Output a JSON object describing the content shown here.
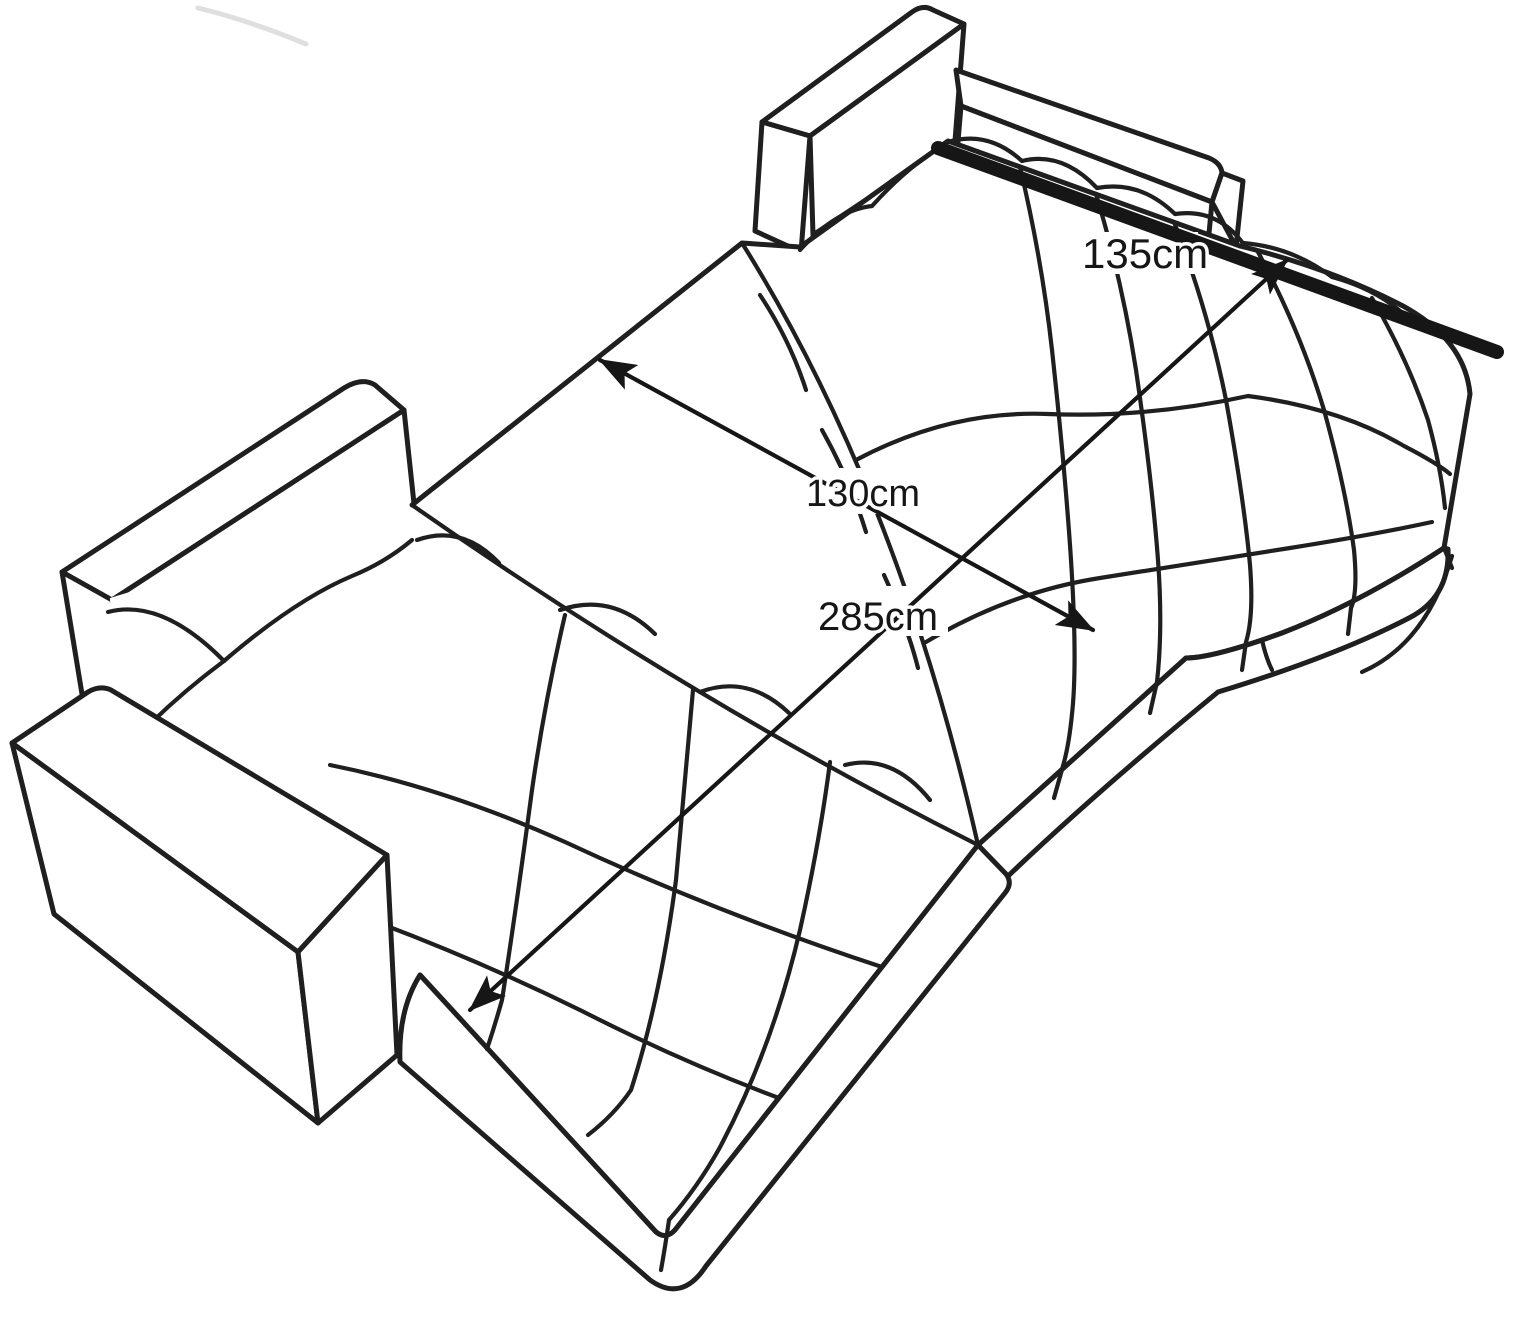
{
  "diagram": {
    "type": "furniture-dimension-line-drawing",
    "subject": "corner sofa bed unfolded into a double bed, isometric outline sketch",
    "colors": {
      "line": "#1f1f1f",
      "dim": "#161616",
      "paper": "#ffffff"
    },
    "dimensions": [
      {
        "id": "sleeping-section-width",
        "label": "135cm",
        "value": 135,
        "unit": "cm"
      },
      {
        "id": "bed-width",
        "label": "130cm",
        "value": 130,
        "unit": "cm"
      },
      {
        "id": "bed-length",
        "label": "285cm",
        "value": 285,
        "unit": "cm"
      }
    ]
  }
}
